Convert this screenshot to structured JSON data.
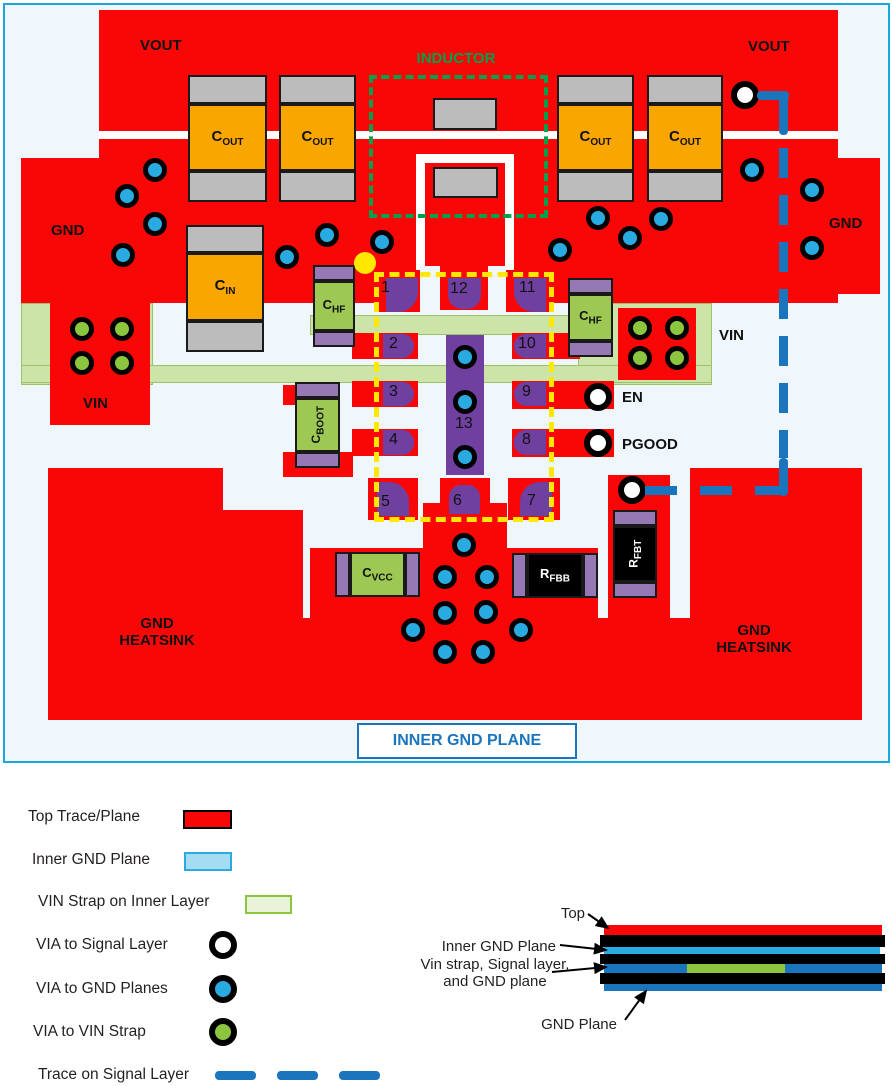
{
  "board": {
    "vout_left": "VOUT",
    "vout_right": "VOUT",
    "gnd_left": "GND",
    "gnd_right": "GND",
    "vin_left": "VIN",
    "vin_right": "VIN",
    "en": "EN",
    "pgood": "PGOOD",
    "inductor": "INDUCTOR",
    "heatsink_line1": "GND",
    "heatsink_line2": "HEATSINK",
    "inner_gnd_plane": "INNER GND PLANE"
  },
  "components": {
    "cout": {
      "main": "C",
      "sub": "OUT"
    },
    "cin": {
      "main": "C",
      "sub": "IN"
    },
    "chf": {
      "main": "C",
      "sub": "HF"
    },
    "cboot": {
      "main": "C",
      "sub": "BOOT"
    },
    "cvcc": {
      "main": "C",
      "sub": "VCC"
    },
    "rfbb": {
      "main": "R",
      "sub": "FBB"
    },
    "rfbt": {
      "main": "R",
      "sub": "FBT"
    }
  },
  "ic": {
    "pins": [
      "1",
      "2",
      "3",
      "4",
      "5",
      "6",
      "7",
      "8",
      "9",
      "10",
      "11",
      "12",
      "13"
    ]
  },
  "legend": {
    "items": [
      {
        "label": "Top Trace/Plane",
        "symbol": "red-plane-swatch",
        "color": "#f90606"
      },
      {
        "label": "Inner GND Plane",
        "symbol": "inner-gnd-swatch",
        "color": "#a5dcf2"
      },
      {
        "label": "VIN Strap on Inner Layer",
        "symbol": "vin-strap-swatch",
        "color": "#e8f3da"
      },
      {
        "label": "VIA to Signal Layer",
        "symbol": "signal-via",
        "color": "#ffffff"
      },
      {
        "label": "VIA to GND Planes",
        "symbol": "gnd-via",
        "color": "#29abe2"
      },
      {
        "label": "VIA to VIN Strap",
        "symbol": "vin-via",
        "color": "#8cc63f"
      },
      {
        "label": "Trace on Signal Layer",
        "symbol": "signal-trace-dash",
        "color": "#1b75bc"
      }
    ]
  },
  "stackup": {
    "top": "Top",
    "inner_gnd": "Inner GND Plane",
    "vin_strap_1": "Vin strap, Signal layer,",
    "vin_strap_2": "and GND plane",
    "gnd_plane": "GND Plane"
  },
  "colors": {
    "top_trace": "#f90606",
    "inner_gnd_plane": "#a5dcf2",
    "vin_strap": "#cde4a9",
    "via_gnd": "#29abe2",
    "via_vin": "#8cc63f",
    "via_signal": "#ffffff",
    "signal_trace": "#1b75bc",
    "inductor_outline": "#00a14b",
    "ic_outline": "#ffe800",
    "pad_purple": "#7040a0",
    "component_green": "#9dc853",
    "component_orange": "#f9a600"
  }
}
